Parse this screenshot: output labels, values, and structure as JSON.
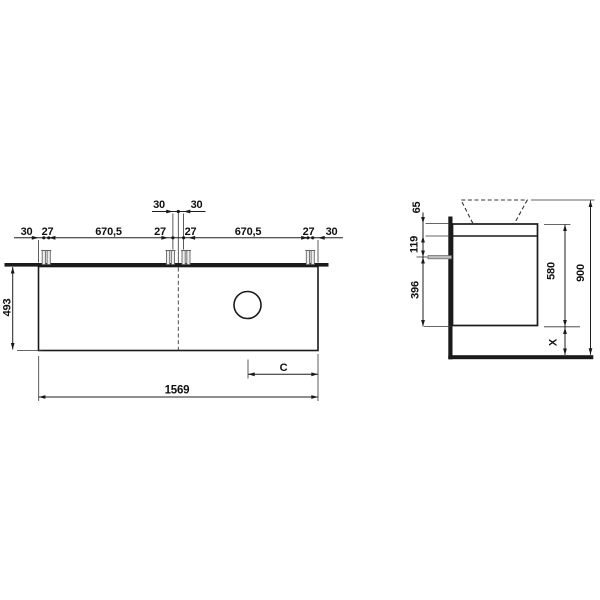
{
  "drawing": {
    "front_view": {
      "upper_dims": [
        "30",
        "30"
      ],
      "mount_dims": [
        "30",
        "27",
        "670,5",
        "27",
        "27",
        "670,5",
        "27",
        "30"
      ],
      "height": "493",
      "width": "1569",
      "cutout_offset": "C"
    },
    "side_view": {
      "left_dims": [
        "65",
        "119",
        "396"
      ],
      "cabinet_height": "580",
      "total_height": "900",
      "bottom_clearance": "X"
    },
    "colors": {
      "ink": "#1a1a1a",
      "background": "#ffffff",
      "screw_fill": "#ededed",
      "screw_stroke": "#666666"
    }
  }
}
